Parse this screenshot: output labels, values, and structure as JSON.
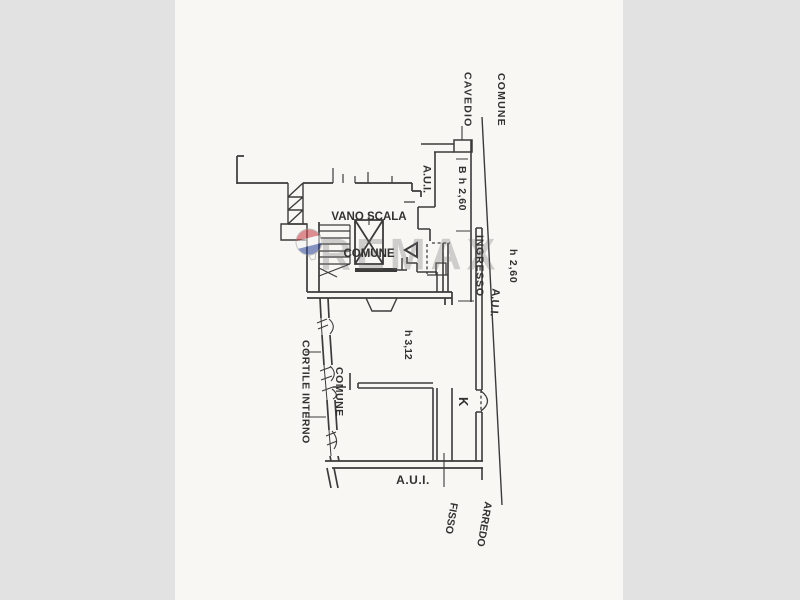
{
  "page": {
    "background_color": "#e2e2e2",
    "paper_color": "#f8f7f4",
    "ink_color": "#3b3b3b"
  },
  "watermark": {
    "brand_text": "REMAX",
    "balloon_red": "#c8373f",
    "balloon_blue": "#2a4396"
  },
  "labels": {
    "cavedio_comune": {
      "lines": [
        "CAVEDIO",
        "COMUNE"
      ]
    },
    "aui_upper": {
      "text": "A.U.I."
    },
    "dim_b": {
      "text": "B h 2,60"
    },
    "vano_scala_comune": {
      "lines": [
        "VANO SCALA",
        "COMUNE"
      ]
    },
    "ingresso": {
      "lines": [
        "INGRESSO",
        "h 2,60"
      ]
    },
    "aui_boundary": {
      "text": "A.U.I."
    },
    "room_height": {
      "text": "h 3,12"
    },
    "cortile_interno_comune": {
      "lines": [
        "CORTILE INTERNO",
        "COMUNE"
      ]
    },
    "room_k": {
      "text": "K"
    },
    "aui_lower": {
      "text": "A.U.I."
    },
    "arredo_fisso": {
      "lines": [
        "ARREDO",
        "FISSO"
      ]
    }
  }
}
